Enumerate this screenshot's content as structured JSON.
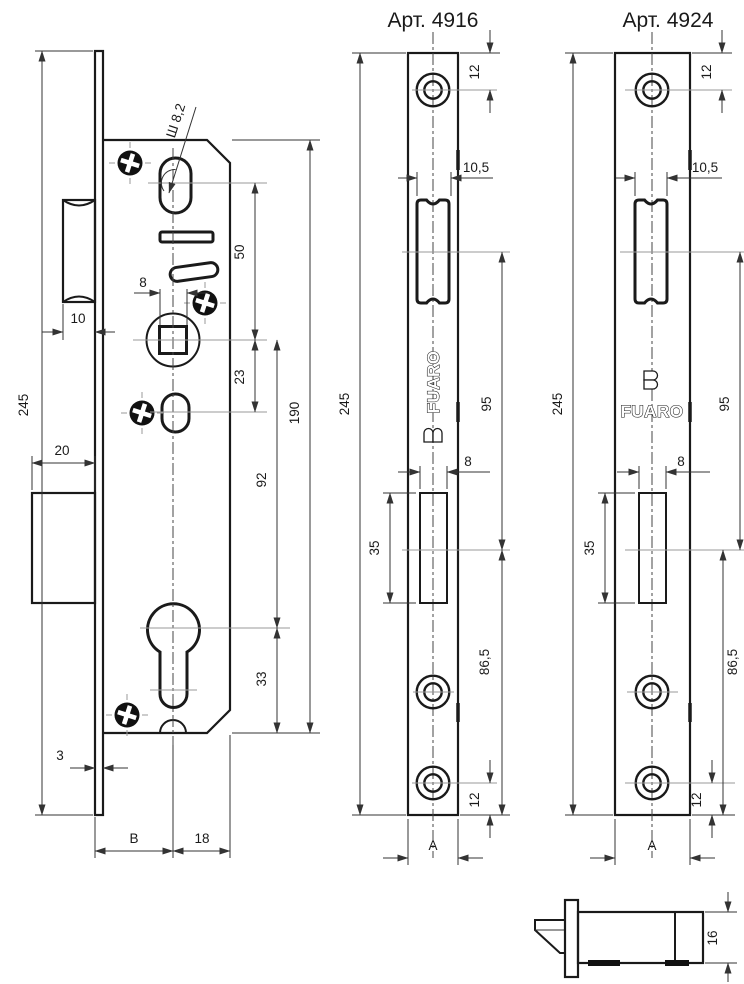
{
  "titles": {
    "left_plate": "Арт. 4916",
    "right_plate": "Арт. 4924"
  },
  "brand": {
    "logo_text": "FUARO"
  },
  "lock_body_view": {
    "dim_overall_height": "245",
    "dim_latch_width": "10",
    "dim_deadbolt_width": "20",
    "dim_faceplate_thickness": "3",
    "dim_backset": "B",
    "dim_axis_to_back_edge": "18",
    "dim_spindle_square": "8",
    "dim_slot_note": "Ш 8,2",
    "dim_oval_to_spindle": "50",
    "dim_spindle_to_lower_oval": "23",
    "dim_spindle_to_cylinder": "92",
    "dim_body_height": "190",
    "dim_cylinder_to_bottom": "33"
  },
  "faceplate_4916": {
    "dim_overall_height": "245",
    "dim_top_screw_to_edge": "12",
    "dim_latch_opening_width": "10,5",
    "dim_latch_to_deadbolt": "95",
    "dim_deadbolt_opening_width": "8",
    "dim_deadbolt_opening_height": "35",
    "dim_deadbolt_to_bottom": "86,5",
    "dim_bottom_screw_to_edge": "12",
    "dim_plate_width": "A"
  },
  "faceplate_4924": {
    "dim_overall_height": "245",
    "dim_top_screw_to_edge": "12",
    "dim_latch_opening_width": "10,5",
    "dim_latch_to_deadbolt": "95",
    "dim_deadbolt_opening_width": "8",
    "dim_deadbolt_opening_height": "35",
    "dim_deadbolt_to_bottom": "86,5",
    "dim_bottom_screw_to_edge": "12",
    "dim_plate_width": "A"
  },
  "side_view": {
    "dim_body_thickness": "16"
  },
  "colors": {
    "line": "#1a1a1a",
    "dim_line": "#333333",
    "background": "#ffffff"
  }
}
